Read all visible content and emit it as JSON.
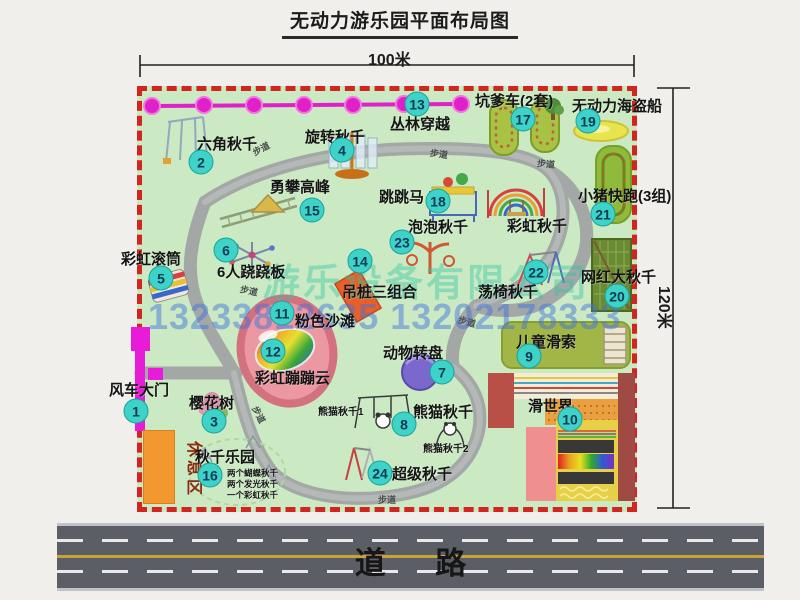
{
  "title": "无动力游乐园平面布局图",
  "dimensions": {
    "width_label": "100米",
    "height_label": "120米"
  },
  "road": {
    "label": "道路"
  },
  "watermark": {
    "company": "游乐设备有限公司",
    "phone": "13233812635 13202178333"
  },
  "walkway_label": "步道",
  "rest_area_label": "休息区",
  "attractions": {
    "a1": {
      "num": "1",
      "name": "风车大门"
    },
    "a2": {
      "num": "2",
      "name": "六角秋千"
    },
    "a3": {
      "num": "3",
      "name": "樱花树"
    },
    "a4": {
      "num": "4",
      "name": "旋转秋千"
    },
    "a5": {
      "num": "5",
      "name": "彩虹滚筒"
    },
    "a6": {
      "num": "6",
      "name": "6人跷跷板"
    },
    "a7": {
      "num": "7",
      "name": "动物转盘"
    },
    "a8": {
      "num": "8",
      "name": "熊猫秋千"
    },
    "a9": {
      "num": "9",
      "name": "儿童滑索"
    },
    "a10": {
      "num": "10",
      "name": "滑世界"
    },
    "a11": {
      "num": "11",
      "name": "粉色沙滩"
    },
    "a12": {
      "num": "12",
      "name": "彩虹蹦蹦云"
    },
    "a13": {
      "num": "13",
      "name": "丛林穿越"
    },
    "a14": {
      "num": "14",
      "name": "吊桩三组合"
    },
    "a15": {
      "num": "15",
      "name": "勇攀高峰"
    },
    "a16": {
      "num": "16",
      "name": "秋千乐园"
    },
    "a17": {
      "num": "17",
      "name": "坑爹车(2套)"
    },
    "a18": {
      "num": "18",
      "name": "跳跳马"
    },
    "a19": {
      "num": "19",
      "name": "无动力海盗船"
    },
    "a20": {
      "num": "20",
      "name": "网红大秋千"
    },
    "a21": {
      "num": "21",
      "name": "小猪快跑(3组)"
    },
    "a22": {
      "num": "22",
      "name": "荡椅秋千"
    },
    "a23": {
      "num": "23",
      "name": "泡泡秋千"
    },
    "a24": {
      "num": "24",
      "name": "超级秋千"
    }
  },
  "unnumbered": {
    "rainbow_swing": "彩虹秋千"
  },
  "notes": {
    "swing_park": [
      "两个蝴蝶秋千",
      "两个发光秋千",
      "一个彩虹秋千"
    ],
    "panda1": "熊猫秋千1",
    "panda2": "熊猫秋千2"
  },
  "colors": {
    "park_fill": "#cbe9c3",
    "park_border": "#d3251f",
    "badge": "#3ed2c9",
    "path_gray": "#a3a8a7",
    "chain_magenta": "#e020c8",
    "road_gray": "#5c5e66",
    "beach_pink": "#eb98a2",
    "rest_orange": "#f2982e"
  }
}
